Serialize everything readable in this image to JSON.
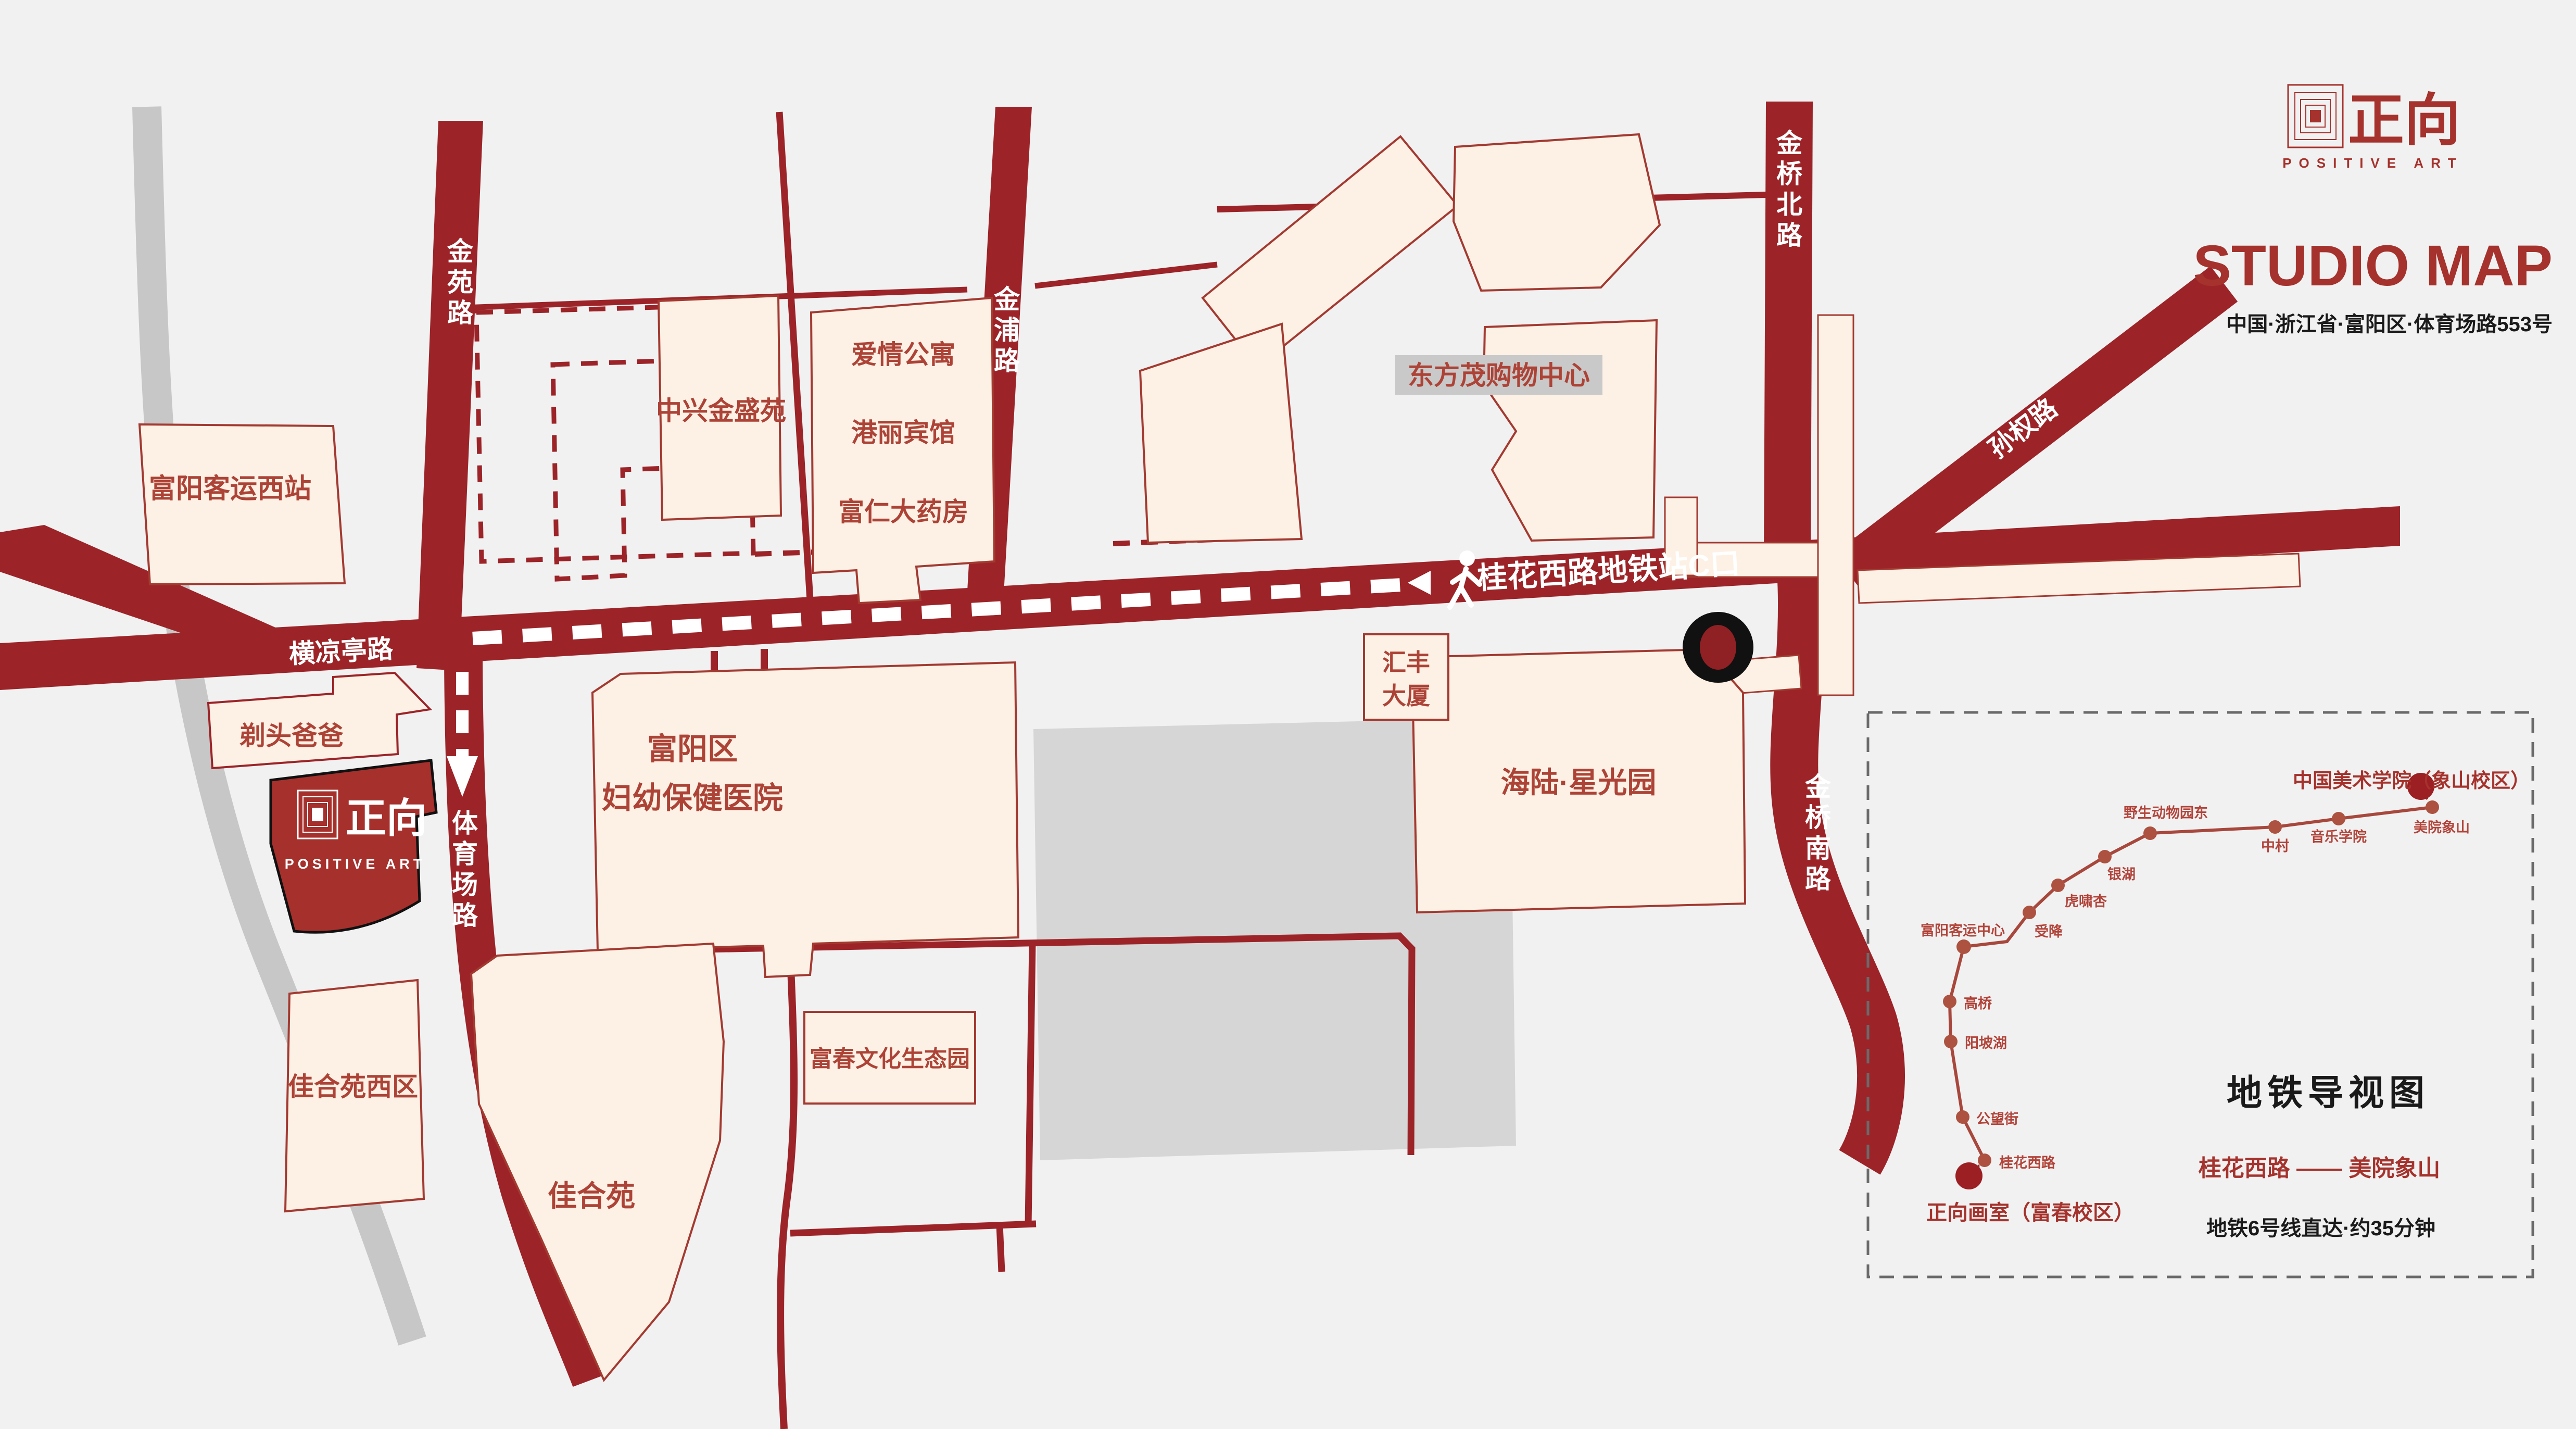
{
  "brand": {
    "logo_cn": "正向",
    "logo_en": "POSITIVE ART",
    "title": "STUDIO MAP",
    "address": "中国·浙江省·富阳区·体育场路553号"
  },
  "roads": {
    "jinyuan": "金苑路",
    "jinpu": "金浦路",
    "jinqiao_north": "金桥北路",
    "jinqiao_south": "金桥南路",
    "sunquan": "孙权路",
    "hengliangting": "横凉亭路",
    "tiyuchang": "体育场路"
  },
  "callout": {
    "metro_exit": "桂花西路地铁站C口"
  },
  "buildings": {
    "fuyang_west_station": "富阳客运西站",
    "zhongxing": "中兴金盛苑",
    "aiqing": "爱情公寓",
    "gangli": "港丽宾馆",
    "furen": "富仁大药房",
    "dongfangmao": "东方茂购物中心",
    "huifeng_l1": "汇丰",
    "huifeng_l2": "大厦",
    "hailu": "海陆·星光园",
    "hospital_l1": "富阳区",
    "hospital_l2": "妇幼保健医院",
    "titou": "剃头爸爸",
    "jiaheyuan_west": "佳合苑西区",
    "jiaheyuan": "佳合苑",
    "fuchun_park": "富春文化生态园"
  },
  "studio_marker": {
    "logo_cn": "正向",
    "logo_en": "POSITIVE ART"
  },
  "metro_panel": {
    "dest_title": "中国美术学院（象山校区）",
    "origin_title": "正向画室（富春校区）",
    "legend_title": "地铁导视图",
    "route": "桂花西路 —— 美院象山",
    "note": "地铁6号线直达·约35分钟",
    "stations": [
      "桂花西路",
      "公望街",
      "阳坡湖",
      "高桥",
      "富阳客运中心",
      "受降",
      "虎啸杏",
      "银湖",
      "野生动物园东",
      "中村",
      "音乐学院",
      "美院象山"
    ]
  },
  "colors": {
    "road_red": "#9c2428",
    "brand_red": "#a5322c",
    "cream": "#fdf1e5",
    "gray_block": "#d7d6d6",
    "metro_line": "#a8473c"
  }
}
